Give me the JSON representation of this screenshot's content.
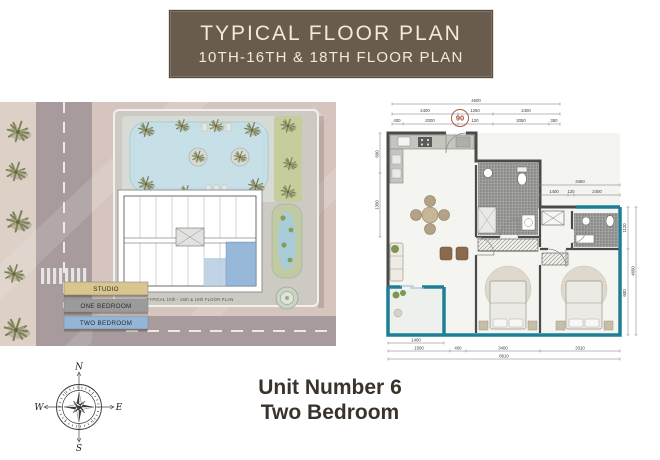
{
  "banner": {
    "title": "TYPICAL FLOOR PLAN",
    "subtitle": "10TH-16TH & 18TH FLOOR PLAN"
  },
  "site_plan": {
    "caption": "TYPICAL 10th - 16th & 18th FLOOR PLAN",
    "legend": [
      {
        "label": "STUDIO",
        "color": "#d8c68e"
      },
      {
        "label": "ONE BEDROOM",
        "color": "#9b9b9b"
      },
      {
        "label": "TWO BEDROOM",
        "color": "#93b5d8"
      }
    ]
  },
  "unit_plan": {
    "badge": "06",
    "dims": {
      "top_total": "4600",
      "top_seg": [
        "2400",
        "1250",
        "2400"
      ],
      "top_sub": [
        "400",
        "2000",
        "120",
        "2050",
        "350"
      ],
      "right_block_total": "3460",
      "right_block_seg": [
        "1400",
        "120",
        "2400"
      ],
      "side_right_total": "4650",
      "side_right_seg": [
        "1120",
        "600"
      ],
      "side_left_seg": [
        "600",
        "1350"
      ],
      "bottom_balcony": "1400",
      "bottom_seg": [
        "1500",
        "400",
        "3400",
        "3310"
      ],
      "bottom_total": "8610"
    }
  },
  "compass": {
    "n": "N",
    "e": "E",
    "s": "S",
    "w": "W"
  },
  "footer": {
    "line1": "Unit Number 6",
    "line2": "Two Bedroom"
  },
  "colors": {
    "banner_brown": "#695c4e",
    "banner_text": "#f2e9da",
    "balcony_teal": "#1d7f96",
    "wall_gray": "#4a4a47",
    "footer_text": "#3a332c",
    "unit_highlight_blue": "#8fb2d6"
  }
}
